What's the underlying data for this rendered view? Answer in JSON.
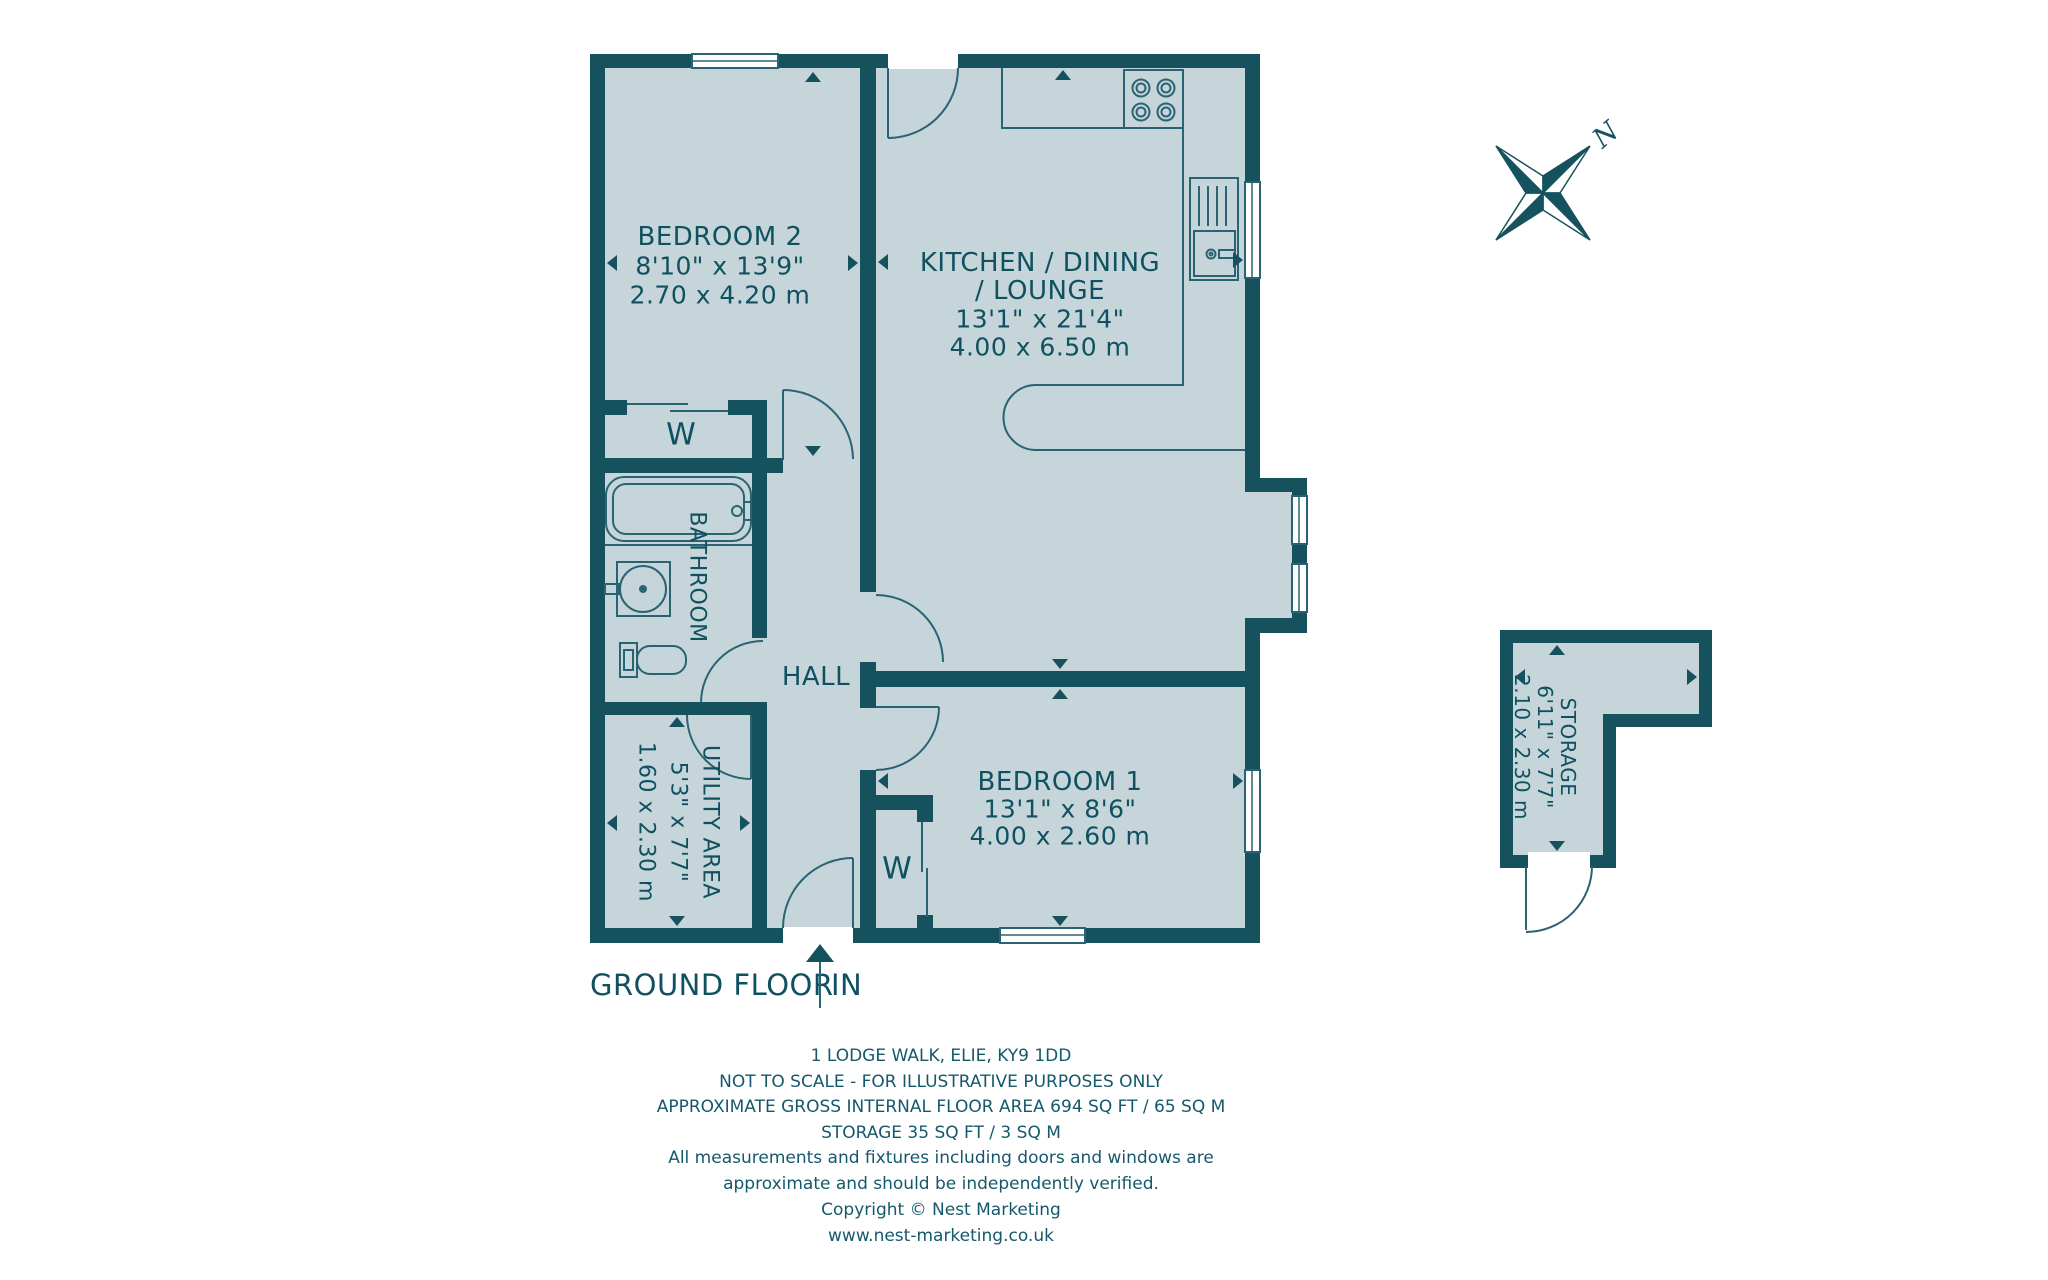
{
  "floor": {
    "label": "GROUND FLOOR",
    "entrance_label": "IN",
    "compass_label": "N"
  },
  "rooms": {
    "bedroom2": {
      "name": "BEDROOM 2",
      "imperial": "8'10\" x 13'9\"",
      "metric": "2.70 x 4.20 m"
    },
    "kitchen": {
      "name_line1": "KITCHEN / DINING",
      "name_line2": "/ LOUNGE",
      "imperial": "13'1\" x 21'4\"",
      "metric": "4.00 x 6.50 m"
    },
    "bedroom1": {
      "name": "BEDROOM 1",
      "imperial": "13'1\" x 8'6\"",
      "metric": "4.00 x 2.60 m"
    },
    "bathroom": {
      "name": "BATHROOM"
    },
    "hall": {
      "name": "HALL"
    },
    "utility": {
      "name": "UTILITY AREA",
      "imperial": "5'3\" x 7'7\"",
      "metric": "1.60 x 2.30 m"
    },
    "storage": {
      "name": "STORAGE",
      "imperial": "6'11\" x 7'7\"",
      "metric": "2.10 x 2.30 m"
    },
    "wardrobe_label": "W"
  },
  "footer": {
    "line1": "1 LODGE WALK, ELIE, KY9 1DD",
    "line2": "NOT TO SCALE - FOR ILLUSTRATIVE PURPOSES ONLY",
    "line3": "APPROXIMATE GROSS INTERNAL FLOOR AREA 694 SQ FT / 65 SQ M",
    "line4": "STORAGE 35 SQ FT / 3 SQ M",
    "line5": "All measurements and fixtures including doors and windows are",
    "line6": "approximate and should be independently verified.",
    "line7": "Copyright © Nest Marketing",
    "line8": "www.nest-marketing.co.uk"
  },
  "colors": {
    "wall": "#16525e",
    "room_fill": "#c6d5da",
    "thin_line": "#2a6373",
    "text": "#0f5160",
    "background": "#ffffff"
  }
}
